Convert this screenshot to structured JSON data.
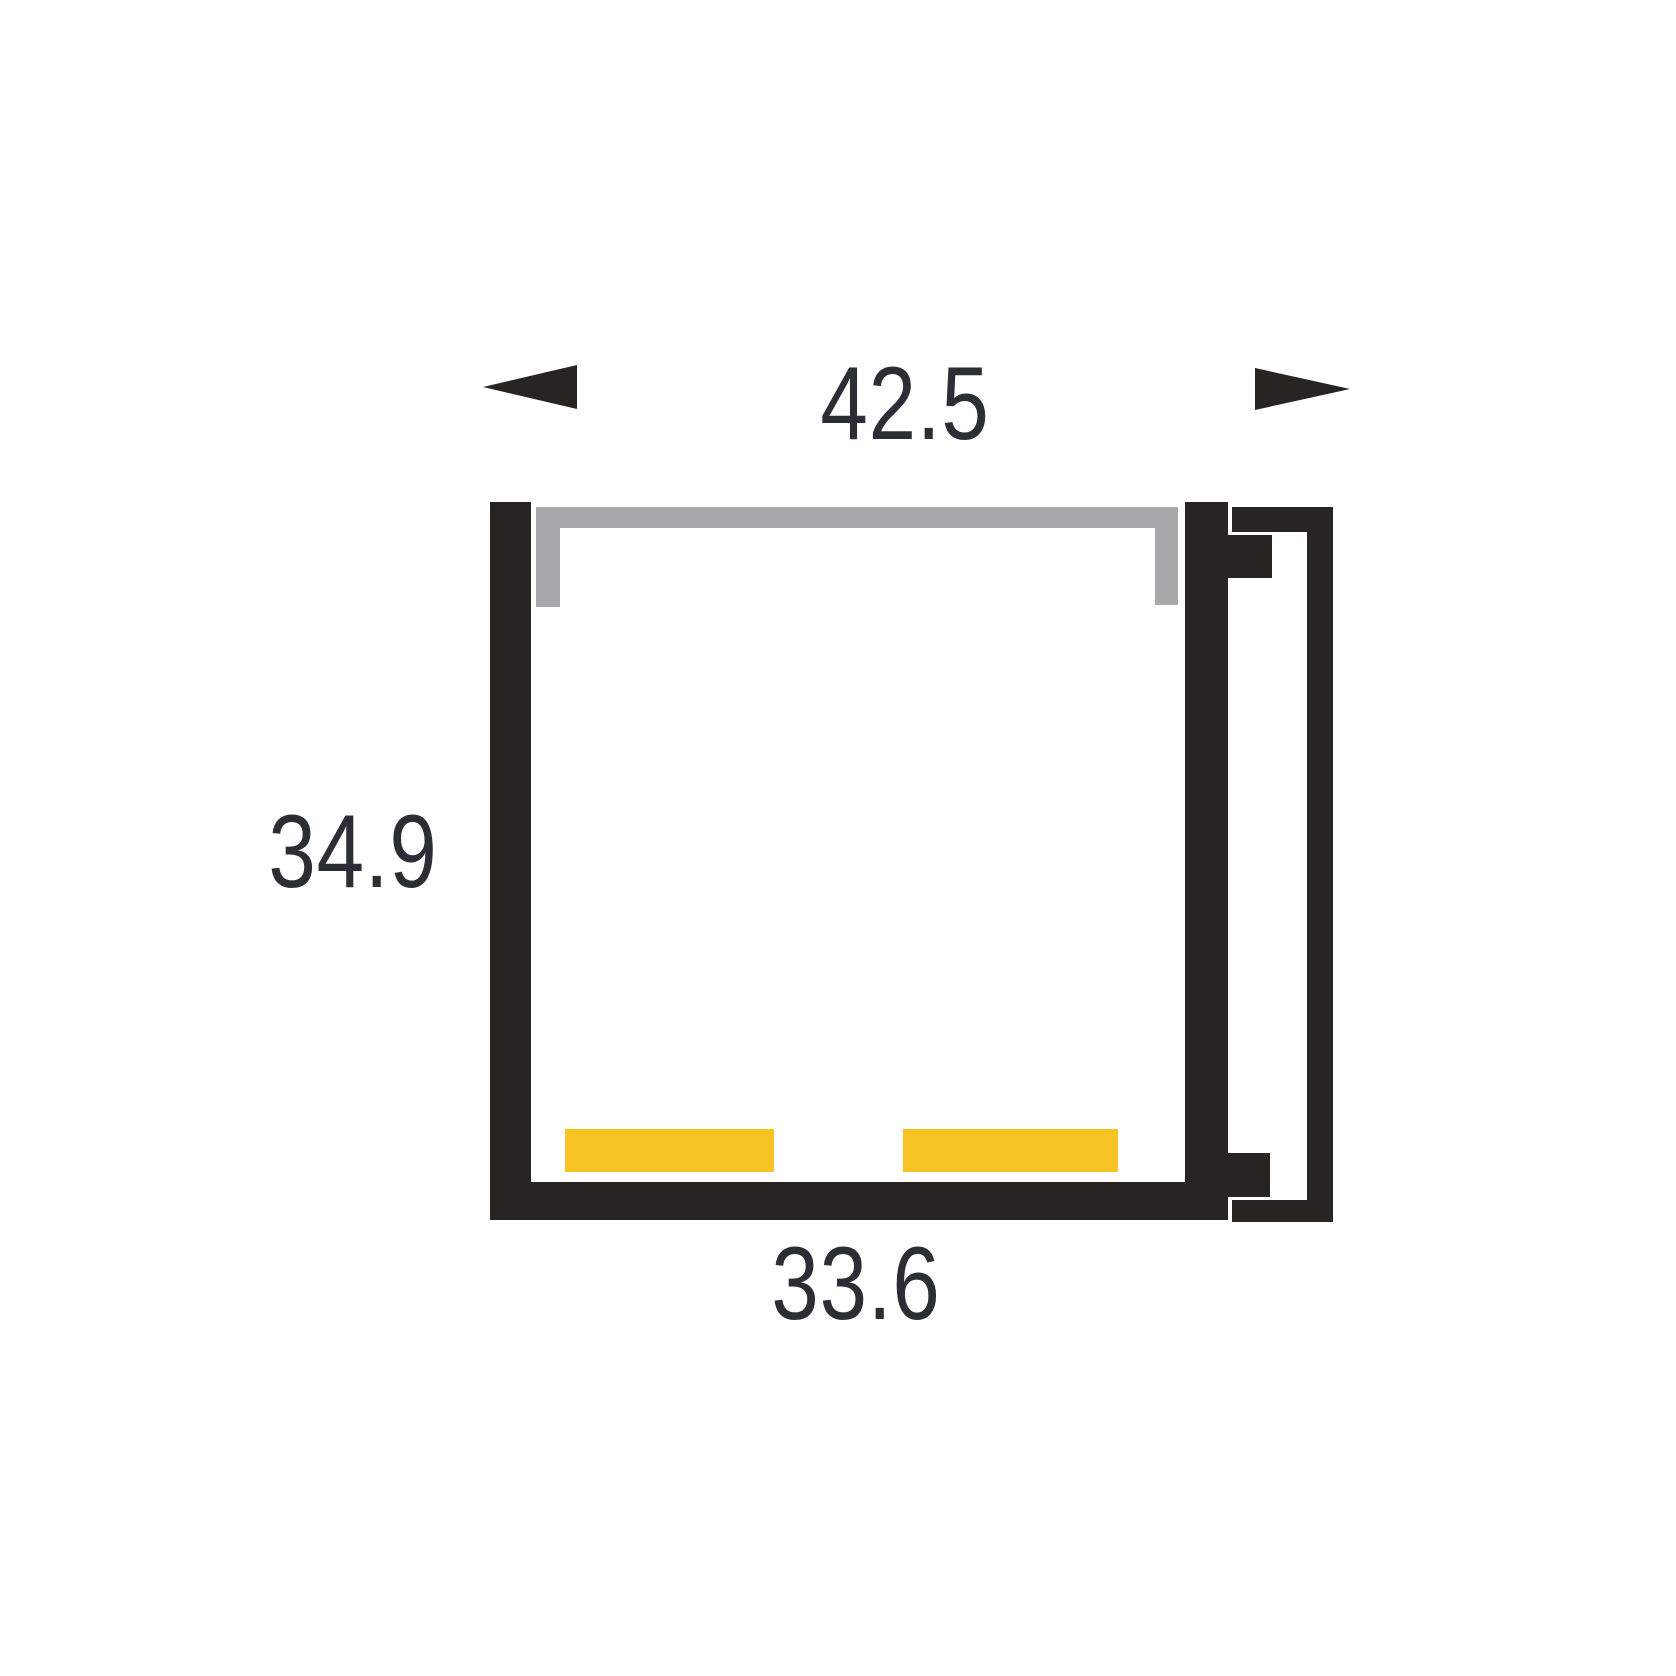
{
  "dimensions": {
    "overall_width": "42.5",
    "overall_height": "34.9",
    "inner_width": "33.6"
  },
  "colors": {
    "profile-black": "#272422",
    "cover-gray": "#A9A9AB",
    "led-yellow": "#F6C224",
    "dim-text": "#2B2E35",
    "bg": "#FFFFFF"
  }
}
